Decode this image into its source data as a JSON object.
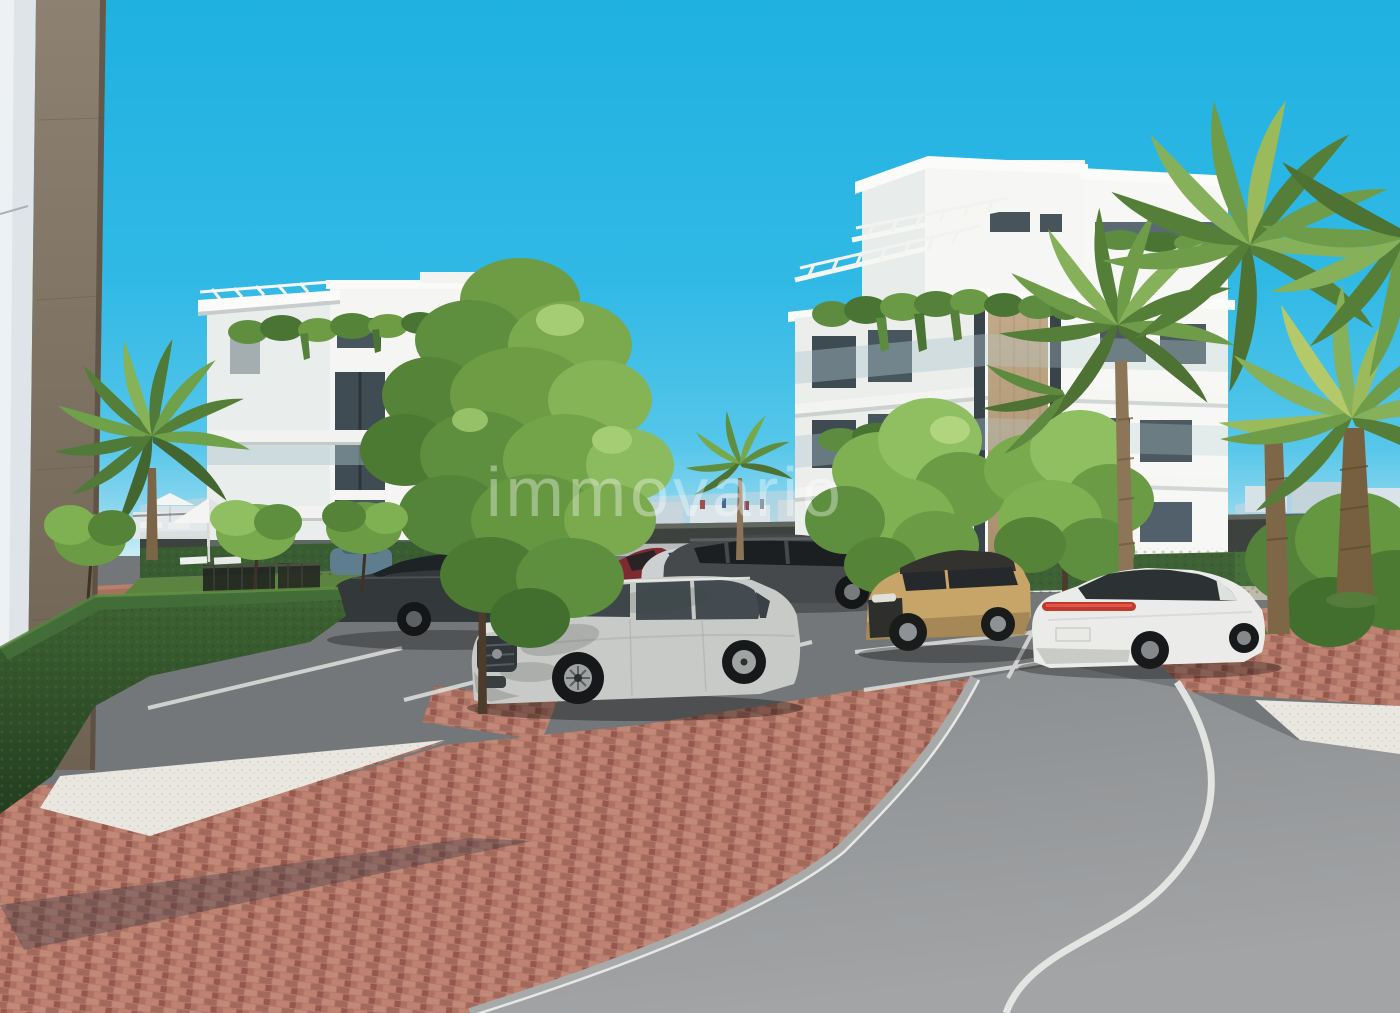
{
  "scene": {
    "kind": "architectural-3d-render",
    "description": "New-build white apartment complex with palm trees, hedges, parked cars, brick walkways and a curving asphalt road under a clear cyan sky",
    "watermark": {
      "text": "immovario",
      "color": "#ffffff",
      "opacity": 0.36
    }
  },
  "palette": {
    "sky_top": "#1fb1e1",
    "sky_horizon": "#c9ecf6",
    "facade_white": "#f5f6f3",
    "facade_shadow": "#e9edec",
    "stone_beige": "#bba27f",
    "stone_dark_column": "#7c6f5e",
    "window_glass": "#47555c",
    "foliage_bright": "#8cba5e",
    "foliage_mid": "#6d9c45",
    "foliage_dark": "#4c7a33",
    "hedge_dark": "#2e4d29",
    "grass": "#5d8340",
    "palm_trunk": "#8d7557",
    "asphalt_parking": "#74777a",
    "asphalt_road": "#979a9c",
    "road_marking": "#e9eae7",
    "brick_paving": "#b5796b",
    "gravel": "#e9e7e0",
    "perimeter_wall": "#3d423e",
    "car_silver": "#c8cac7",
    "car_dark_gray": "#46494b",
    "car_tan": "#c7a468",
    "car_white": "#ebece9",
    "car_red": "#7e2a31",
    "taillight_red": "#c23a2c"
  },
  "objects": [
    "left-corner-building",
    "left-apartment-building",
    "right-apartment-building",
    "rooftop-pergolas",
    "balcony-hanging-plants",
    "palm-trees",
    "deciduous-trees",
    "boxwood-hedges",
    "lawn",
    "white-parasol",
    "sun-loungers",
    "metal-fence",
    "perimeter-wall",
    "distant-skyline",
    "parking-area",
    "parking-markings",
    "main-silver-suv",
    "dark-gray-suv",
    "gray-sedan",
    "red-hatchback",
    "silver-car",
    "tan-compact-suv",
    "white-sedan",
    "distant-car",
    "stone-benches",
    "brick-walkway",
    "gravel-strips",
    "asphalt-road",
    "road-edge-line",
    "tree-shadow"
  ]
}
